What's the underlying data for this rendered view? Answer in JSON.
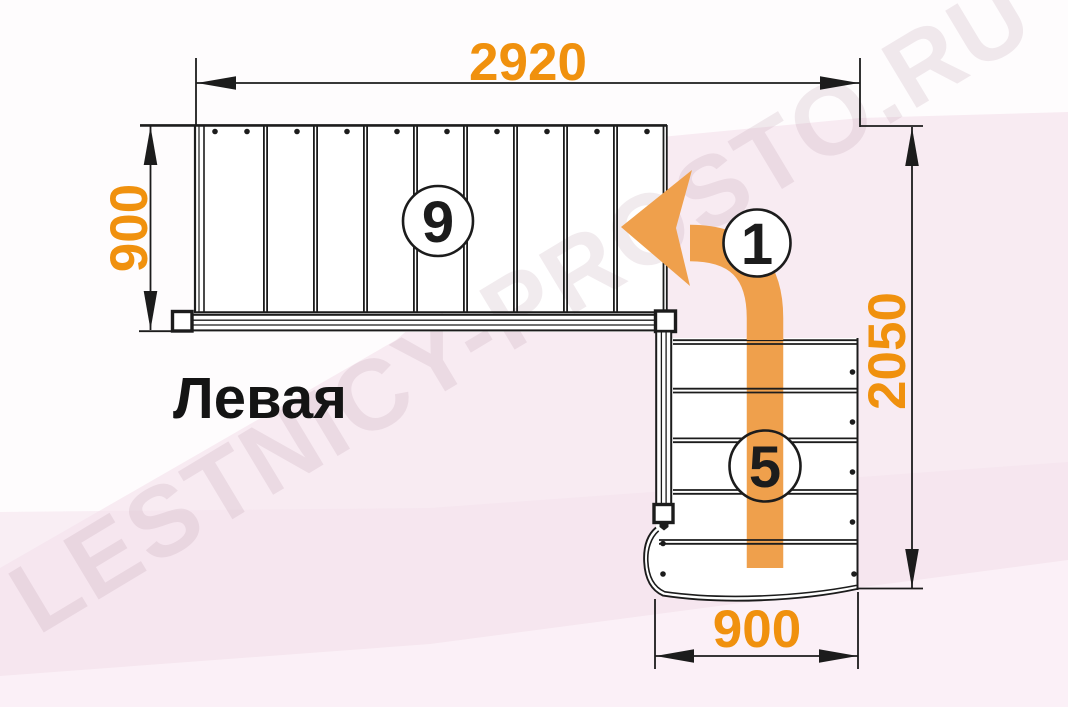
{
  "diagram": {
    "orientation_label": "Левая",
    "watermark": "LESTNICY-PROSTO.RU",
    "dimensions": {
      "top_width_mm": "2920",
      "upper_flight_width_mm": "900",
      "total_depth_mm": "2050",
      "lower_flight_width_mm": "900"
    },
    "markers": {
      "upper_flight_steps": "9",
      "start_step": "1",
      "lower_flight_steps": "5"
    },
    "counts": {
      "upper_flight_treads": 9,
      "lower_flight_treads": 5
    },
    "colors": {
      "dimension_text": "#F0910E",
      "arrow": "#EFA04C",
      "line": "#1C1C1C",
      "background_pink": "#F8EBF2",
      "surface": "#FFFFFF"
    }
  }
}
